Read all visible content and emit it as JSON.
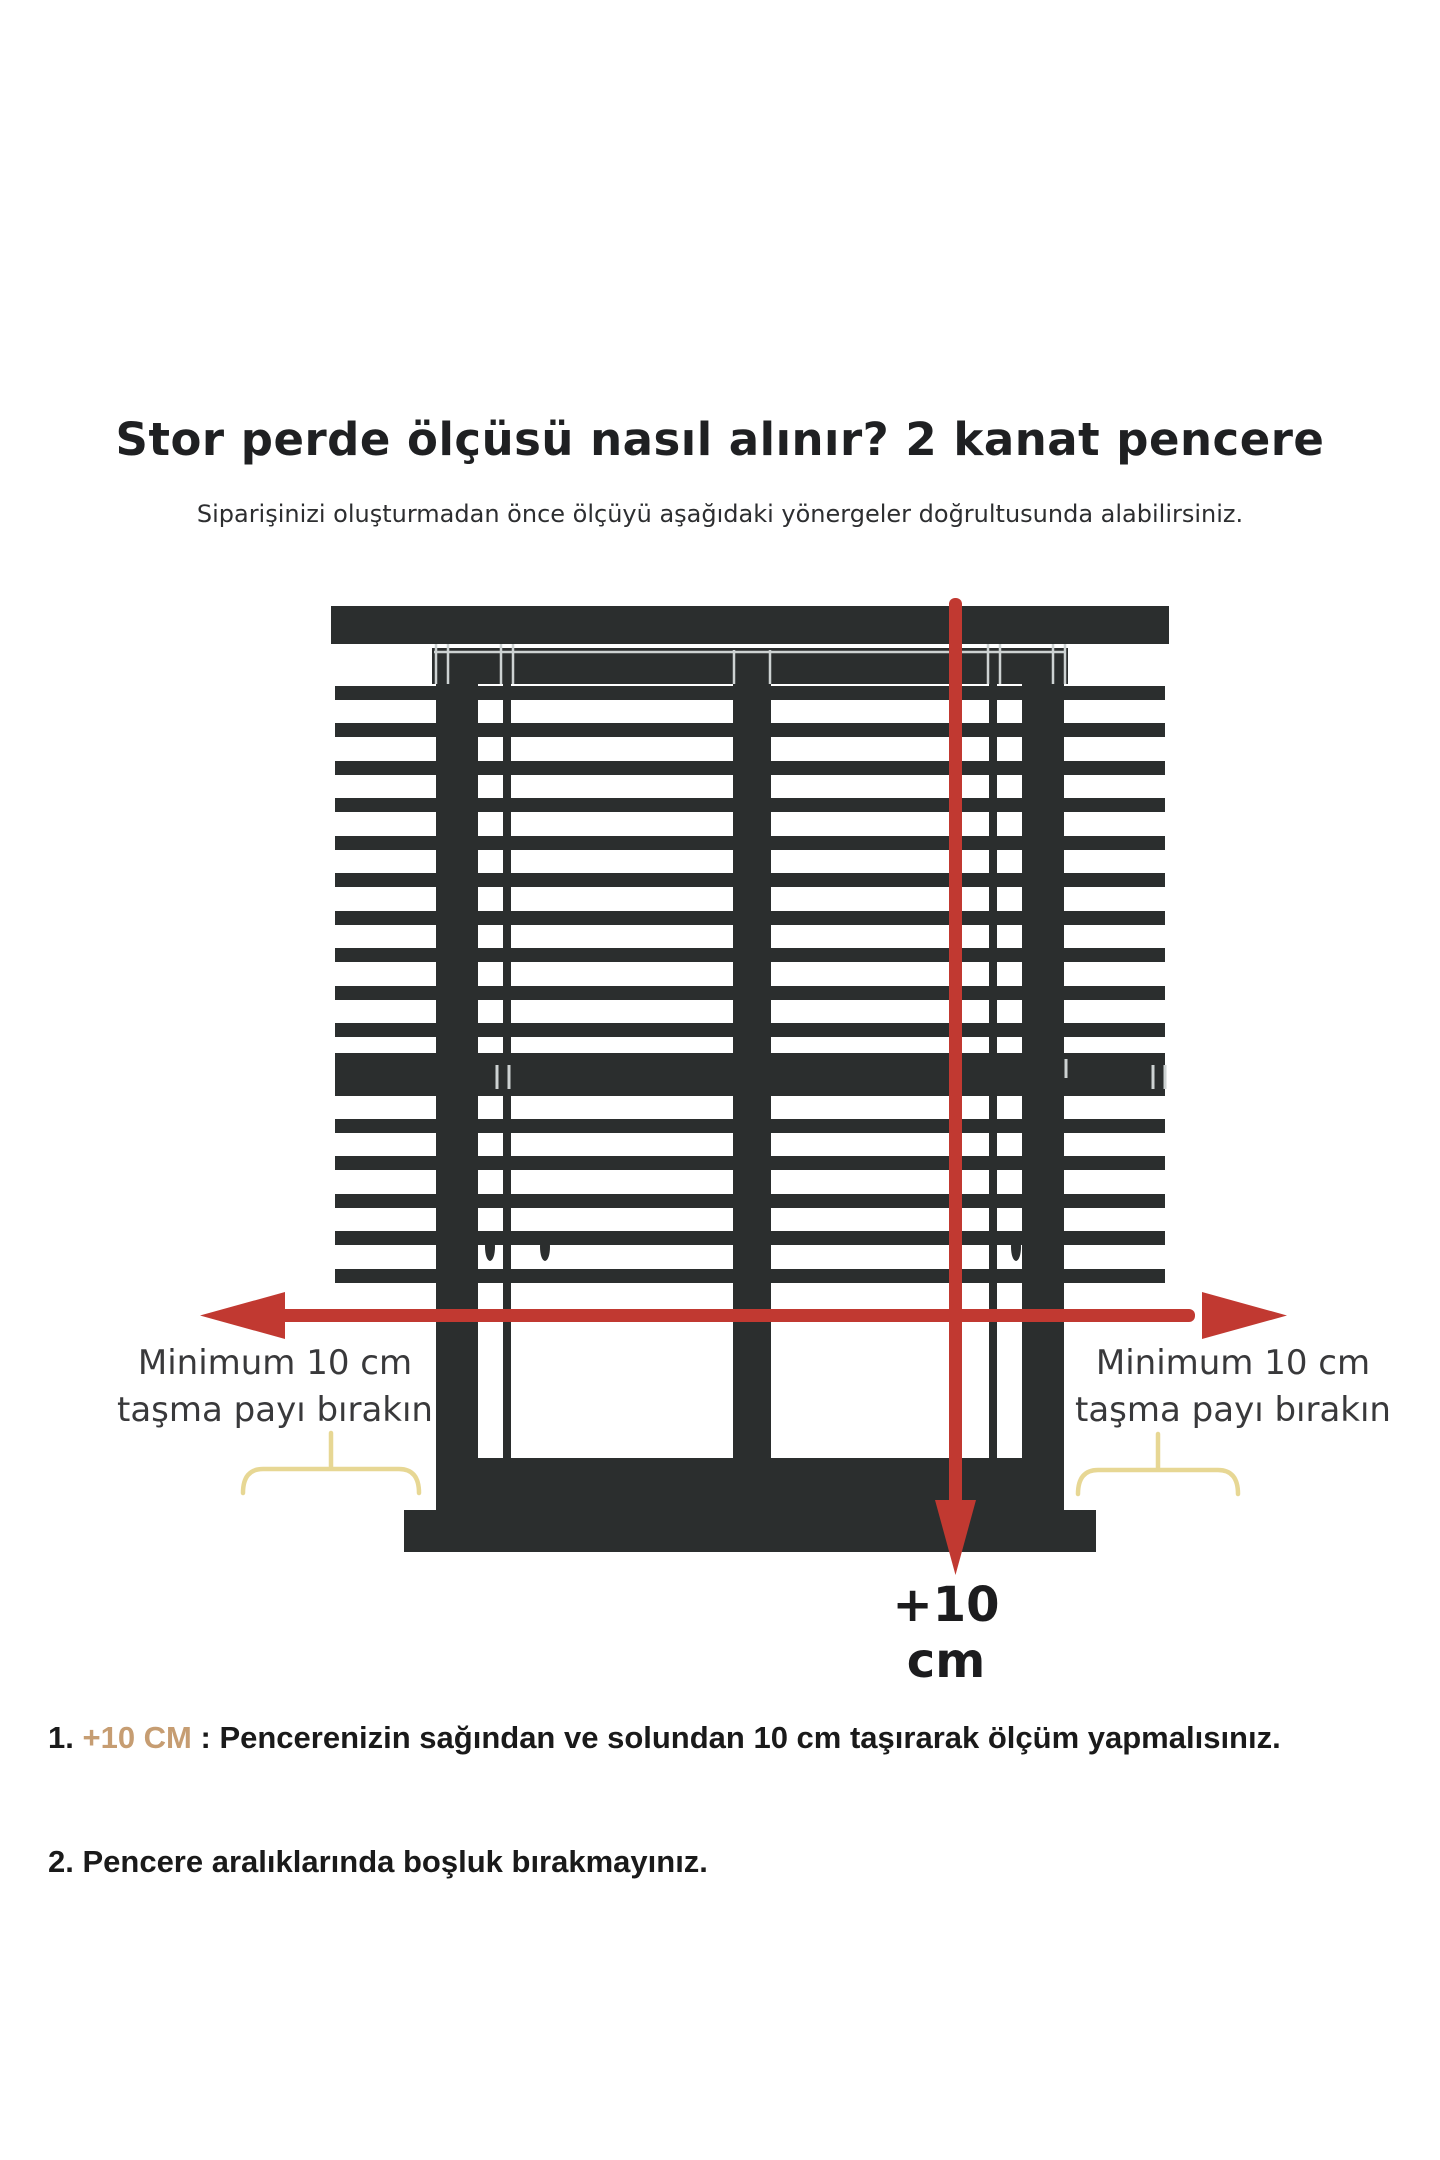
{
  "header": {
    "title": "Stor perde ölçüsü nasıl alınır? 2 kanat pencere",
    "subtitle": "Siparişinizi oluşturmadan önce ölçüyü aşağıdaki yönergeler doğrultusunda alabilirsiniz."
  },
  "diagram": {
    "left_overhang_label": {
      "line1": "Minimum 10 cm",
      "line2": "taşma payı bırakın"
    },
    "right_overhang_label": {
      "line1": "Minimum 10 cm",
      "line2": "taşma payı bırakın"
    },
    "height_arrow_label": "+10 cm"
  },
  "notes": {
    "item1": {
      "number": "1. ",
      "highlight": "+10 CM",
      "rest": " : Pencerenizin sağından ve solundan 10 cm taşırarak ölçüm yapmalısınız."
    },
    "item2": {
      "number": "2. ",
      "rest": "Pencere aralıklarında boşluk bırakmayınız."
    }
  },
  "colors": {
    "frame_dark": "#2b2e2e",
    "frame_highlight": "#cdd2d2",
    "arrow_red": "#c13931",
    "bracket_yellow": "#e7d794",
    "note_highlight_tan": "#c69d72"
  }
}
